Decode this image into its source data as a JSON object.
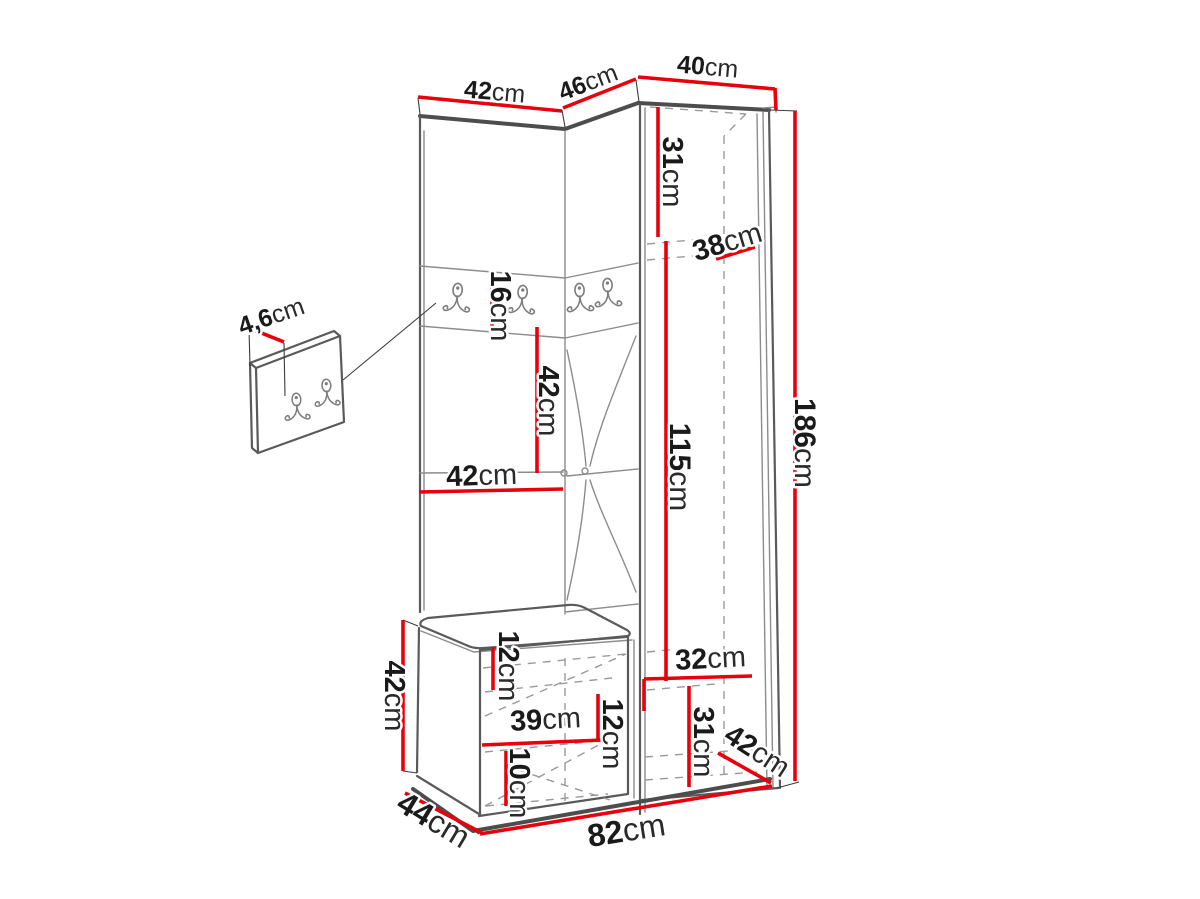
{
  "diagram_title": "Hallway wardrobe set dimension drawing",
  "colors": {
    "dimension_red": "#e8000c",
    "outline_dark": "#4d4d4d",
    "outline_light": "#8c8c8c",
    "dashed_gray": "#9a9a9a",
    "label_text": "#1a1a1a",
    "background": "#ffffff"
  },
  "icons": {
    "coat_hook": "double-prong-coat-hook"
  },
  "dimensions": {
    "top_left_width": {
      "value": "42",
      "unit": "cm"
    },
    "top_middle_width": {
      "value": "46",
      "unit": "cm"
    },
    "top_right_width": {
      "value": "40",
      "unit": "cm"
    },
    "upper_right_inner_height": {
      "value": "31",
      "unit": "cm"
    },
    "upper_shelf_depth": {
      "value": "38",
      "unit": "cm"
    },
    "hook_panel_height": {
      "value": "16",
      "unit": "cm"
    },
    "open_shelf_height": {
      "value": "42",
      "unit": "cm"
    },
    "panel_width": {
      "value": "42",
      "unit": "cm"
    },
    "wardrobe_inner_height": {
      "value": "115",
      "unit": "cm"
    },
    "total_height": {
      "value": "186",
      "unit": "cm"
    },
    "wall_panel_depth": {
      "value": "4,6",
      "unit": "cm"
    },
    "bench_height": {
      "value": "42",
      "unit": "cm"
    },
    "bench_top_inset": {
      "value": "12",
      "unit": "cm"
    },
    "bench_inner_width": {
      "value": "39",
      "unit": "cm"
    },
    "bench_inner_height": {
      "value": "12",
      "unit": "cm"
    },
    "bench_bottom_inset": {
      "value": "10",
      "unit": "cm"
    },
    "lower_inner_width": {
      "value": "32",
      "unit": "cm"
    },
    "lower_inner_height": {
      "value": "31",
      "unit": "cm"
    },
    "lower_depth": {
      "value": "42",
      "unit": "cm"
    },
    "bench_depth": {
      "value": "44",
      "unit": "cm"
    },
    "total_width": {
      "value": "82",
      "unit": "cm"
    }
  }
}
